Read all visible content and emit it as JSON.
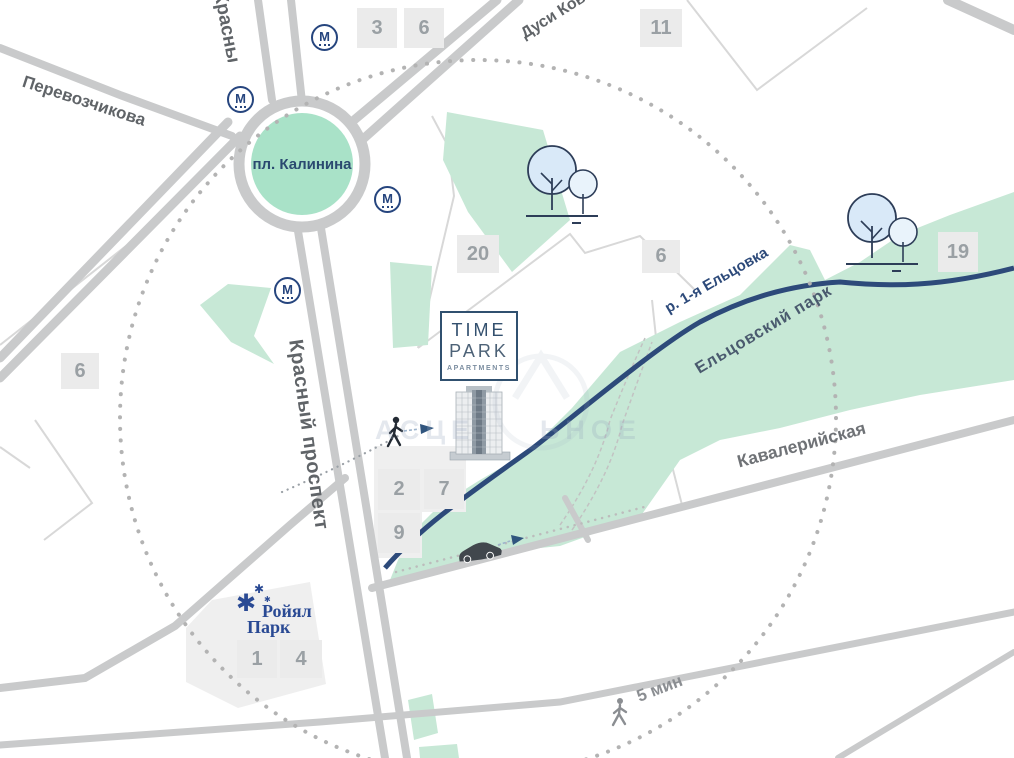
{
  "map": {
    "colors": {
      "park_green": "#c7e8d6",
      "roundabout_green": "#a9e2c8",
      "road_gray": "#c9cacb",
      "river_navy": "#2d4a7a",
      "badge_bg": "#ebebeb",
      "badge_text": "#9aa0a4",
      "brand_navy": "#2a4a94"
    },
    "streets": [
      {
        "id": "perevozchikova",
        "label": "Перевозчикова"
      },
      {
        "id": "krasny-prospekt-north",
        "label": "Красный проспект"
      },
      {
        "id": "krasny-prospekt",
        "label": "Красный проспект"
      },
      {
        "id": "dusi-kovalchuk",
        "label": "Дуси Ковальчук"
      },
      {
        "id": "kavaleriyskaya",
        "label": "Кавалерийская"
      }
    ],
    "square_label": "пл. Калинина",
    "river_label": "р. 1-я Ельцовка",
    "park_label": "Ельцовский парк",
    "walk_time": "5 мин",
    "metro_label": "М",
    "badges": [
      "3",
      "6",
      "11",
      "20",
      "6",
      "19",
      "6",
      "2",
      "7",
      "9",
      "1",
      "4"
    ],
    "logos": {
      "time_park": {
        "line1": "TIME",
        "line2": "PARK",
        "line3": "APARTMENTS"
      },
      "royal_park": {
        "line1": "Ройял",
        "line2": "Парк",
        "star": "✱"
      }
    },
    "watermark": {
      "left": "АСЦЕ",
      "right": "ЬНОЕ"
    }
  }
}
